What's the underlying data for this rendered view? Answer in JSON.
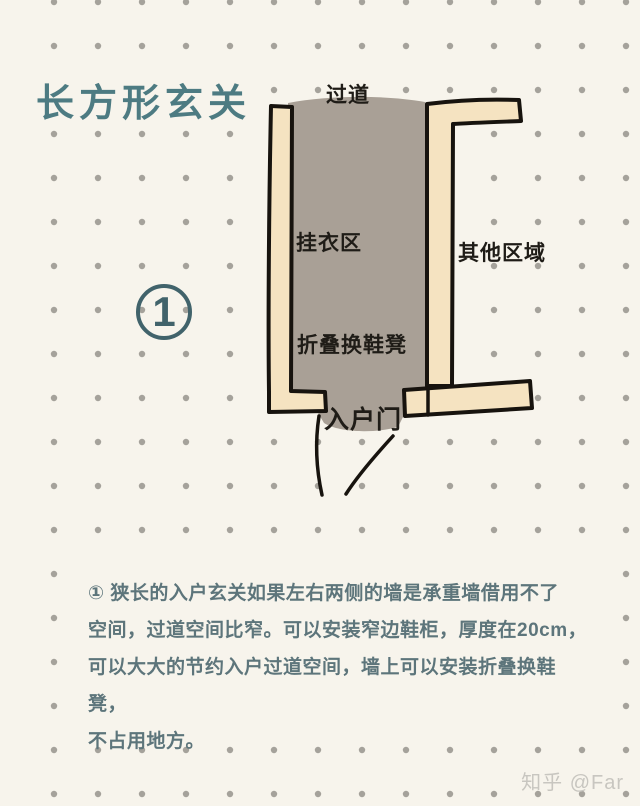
{
  "page": {
    "bg": "#f7f4ec"
  },
  "title": {
    "text": "长方形玄关",
    "color": "#4d7b82"
  },
  "badge": {
    "number": "1",
    "color": "#41636b"
  },
  "diagram": {
    "labels": {
      "corridor": "过道",
      "hanging_area": "挂衣区",
      "other_area": "其他区域",
      "folding_stool": "折叠换鞋凳",
      "entry_door": "入户门"
    },
    "colors": {
      "wall_fill": "#f5e3c1",
      "outline": "#17130e",
      "floor": "#a9a096"
    }
  },
  "description": {
    "text": "①  狭长的入户玄关如果左右两侧的墙是承重墙借用不了\n空间，过道空间比窄。可以安装窄边鞋柜，厚度在20cm，\n可以大大的节约入户过道空间，墙上可以安装折叠换鞋凳，\n不占用地方。",
    "color": "#5d757b"
  },
  "watermark": {
    "text": "知乎 @Far",
    "color": "#c8c6c0"
  },
  "background": {
    "dot_color": "#a5a29b",
    "dot_spacing": 44,
    "dot_radius": 3.2,
    "origin_x": 54,
    "origin_y": 2
  }
}
